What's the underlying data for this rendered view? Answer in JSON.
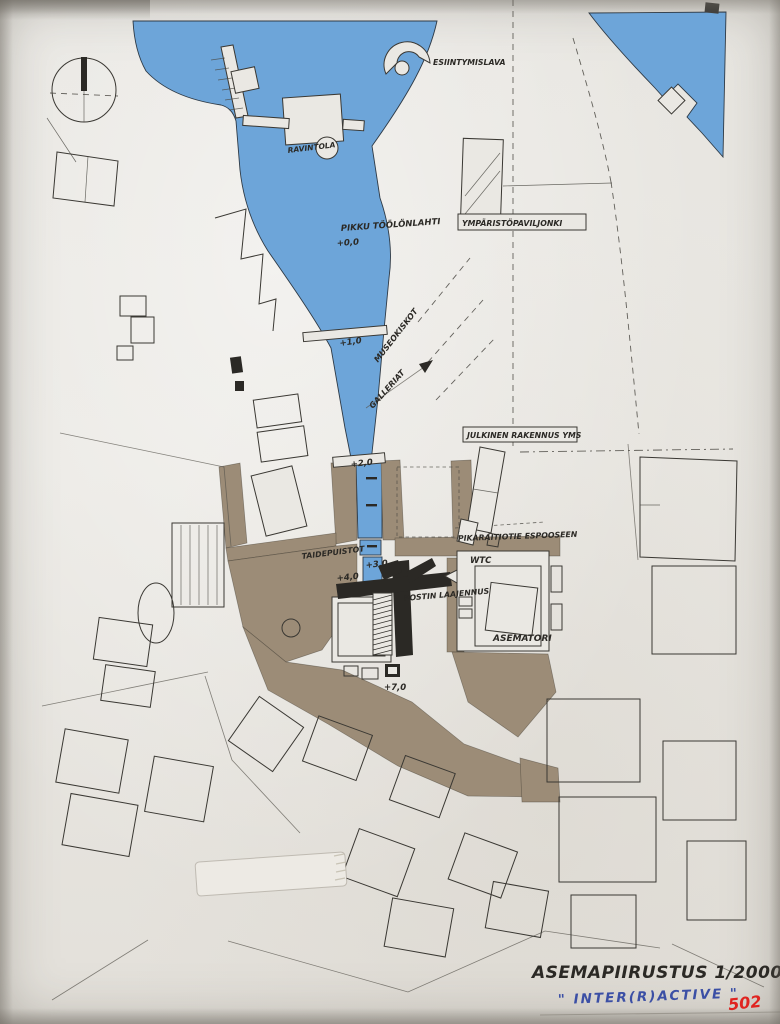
{
  "document": {
    "title": "ASEMAPIIRUSTUS 1/2000",
    "subtitle": "\" INTER(R)ACTIVE \"",
    "sheet_number": "502"
  },
  "map_labels": {
    "esiintymislava": "ESIINTYMISLAVA",
    "ravintola": "RAVINTOLA",
    "pikku_toolonlahti": "PIKKU TÖÖLÖNLAHTI",
    "ymparistopaviljonki": "YMPÄRISTÖPAVILJONKI",
    "museokiskot": "MUSEOKISKOT",
    "galleriat": "GALLERIAT",
    "julkinen_rakennus_yms": "JULKINEN RAKENNUS YMS",
    "pikaraitiotie_espooseen": "PIKARAITIOTIE ESPOOSEEN",
    "taidepuistot": "TAIDEPUISTOT",
    "wtc": "WTC",
    "postin_laajennus": "POSTIN LAAJENNUS",
    "asematori": "ASEMATORI"
  },
  "elevations": {
    "e00": "+0,0",
    "e10": "+1,0",
    "e20": "+2,0",
    "e30": "+3,0",
    "e40": "+4,0",
    "e70": "+7,0"
  },
  "icons": {
    "compass": "north-arrow-compass",
    "stage": "amphitheater-fan",
    "pin": "push-pin"
  },
  "colors": {
    "water": "#6da5d9",
    "ground": "#9c8c77",
    "paper": "#eae8e3",
    "ink": "#2b2925",
    "pen_blue": "#3b4fa5",
    "marker_red": "#e02420"
  }
}
